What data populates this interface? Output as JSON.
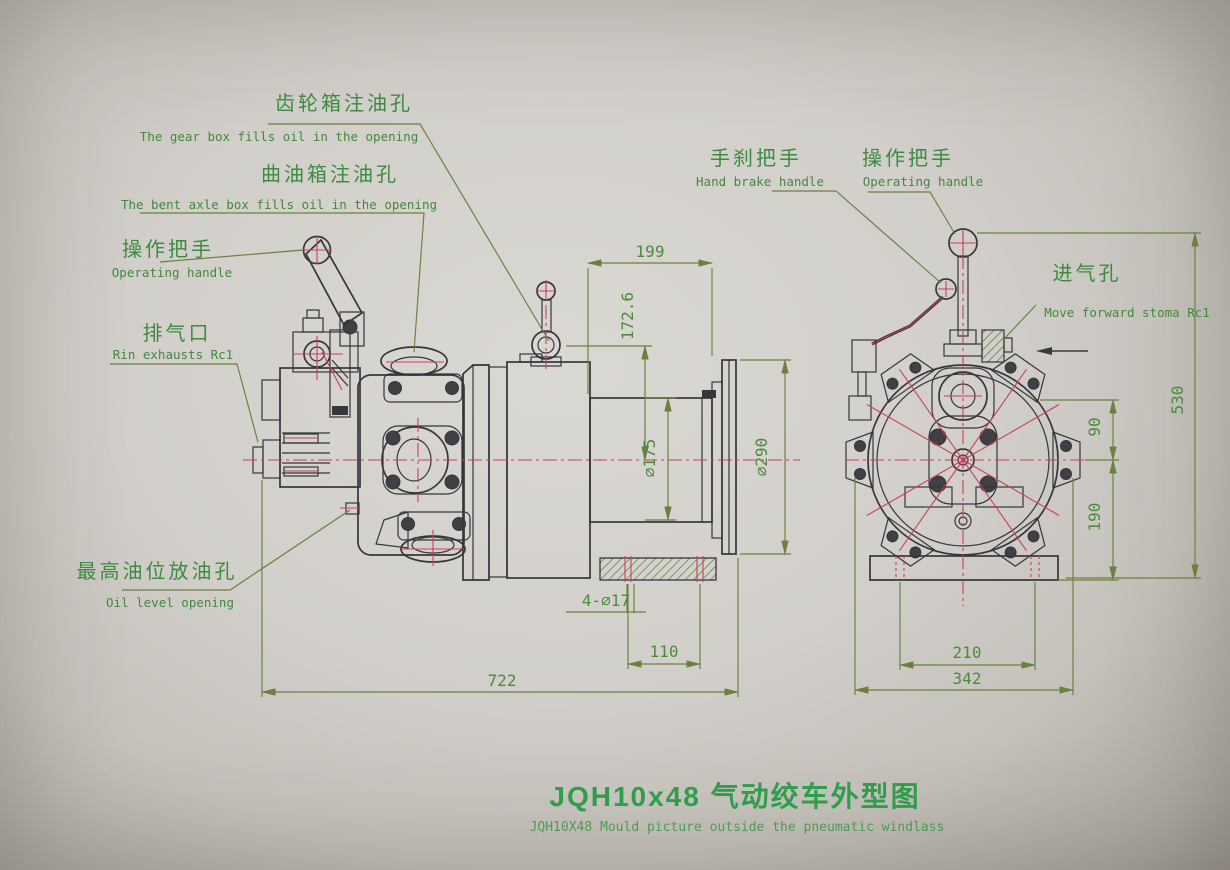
{
  "title": {
    "main": "JQH10x48 气动绞车外型图",
    "sub": "JQH10X48 Mould picture outside the pneumatic windlass"
  },
  "callouts": {
    "gear_box_oil": {
      "zh": "齿轮箱注油孔",
      "en": "The gear box fills oil in the opening"
    },
    "crank_box_oil": {
      "zh": "曲油箱注油孔",
      "en": "The bent axle box fills oil in the opening"
    },
    "operating_handle_l": {
      "zh": "操作把手",
      "en": "Operating handle"
    },
    "exhaust": {
      "zh": "排气口",
      "en": "Rin exhausts Rc1"
    },
    "oil_level": {
      "zh": "最高油位放油孔",
      "en": "Oil level opening"
    },
    "hand_brake": {
      "zh": "手刹把手",
      "en": "Hand brake handle"
    },
    "operating_handle_r": {
      "zh": "操作把手",
      "en": "Operating handle"
    },
    "air_inlet": {
      "zh": "进气孔",
      "en": "Move forward stoma Rc1"
    }
  },
  "dimensions": {
    "side_view": {
      "drum_length": "199",
      "fill_height": "172.6",
      "drum_diameter": "⌀175",
      "flange_diameter": "⌀290",
      "bolt_holes": "4-⌀17",
      "hole_spacing": "110",
      "overall_length": "722"
    },
    "front_view": {
      "upper_offset": "90",
      "lower_offset": "190",
      "overall_height": "530",
      "base_bolt_spacing": "210",
      "base_width": "342"
    }
  },
  "colors": {
    "paper": "#d2cfca",
    "outline": "#36363b",
    "centerline": "#c9405a",
    "dimension_line": "#6b7f3e",
    "label_text": "#3c8b41",
    "title_text": "#2f9e4b"
  }
}
